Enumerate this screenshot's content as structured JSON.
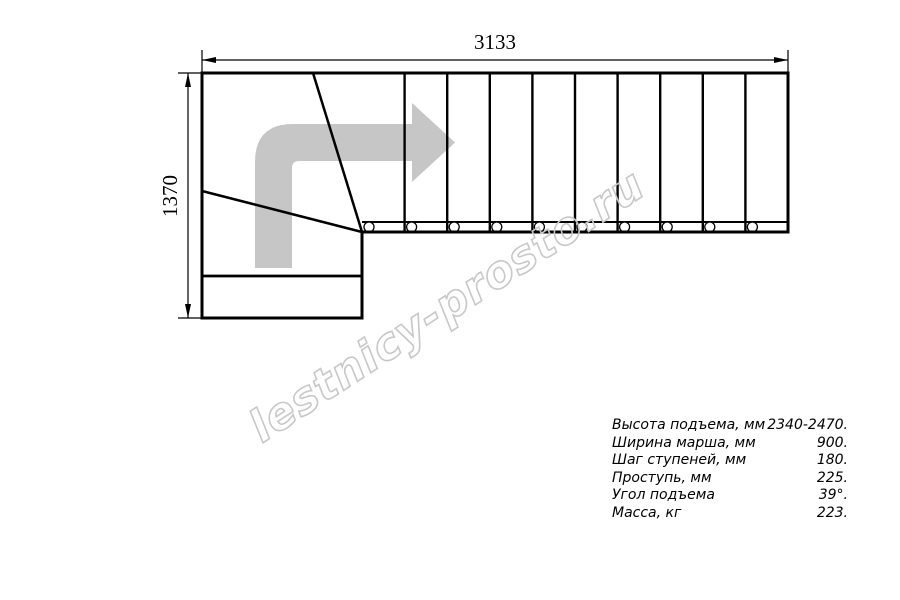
{
  "drawing": {
    "width_mm": "3133",
    "height_mm": "1370"
  },
  "stairs": {
    "straight_step_count": 10,
    "baluster_count": 10,
    "winder_division_lines": 2,
    "arrow_color": "#c6c6c6",
    "line_color": "#000000"
  },
  "watermark": {
    "text": "lestnicy-prosto.ru",
    "color": "#c8c8c8"
  },
  "specs": {
    "rows": [
      {
        "label": "Высота подъема, мм",
        "value": "2340-2470."
      },
      {
        "label": "Ширина марша, мм",
        "value": "900."
      },
      {
        "label": "Шаг ступеней, мм",
        "value": "180."
      },
      {
        "label": "Проступь, мм",
        "value": "225."
      },
      {
        "label": "Угол подъема",
        "value": "39°."
      },
      {
        "label": "Масса, кг",
        "value": "223."
      }
    ]
  }
}
